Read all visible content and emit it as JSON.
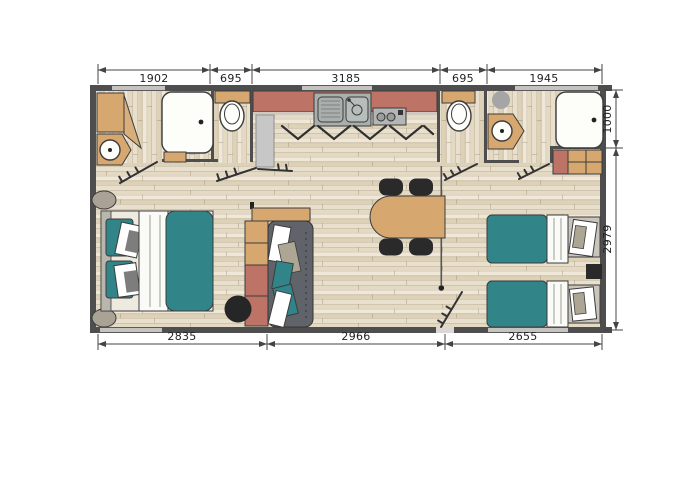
{
  "floorplan": {
    "dimensions": {
      "top": [
        "1902",
        "695",
        "3185",
        "695",
        "1945"
      ],
      "bottom": [
        "2835",
        "2966",
        "2655"
      ],
      "right": [
        "1000",
        "2979"
      ]
    },
    "colors": {
      "wall": "#4e4e4e",
      "terracotta": "#bd7466",
      "tan": "#d6a76f",
      "teal": "#318487",
      "line": "#3c3c3c",
      "dim_text": "#222222"
    }
  }
}
